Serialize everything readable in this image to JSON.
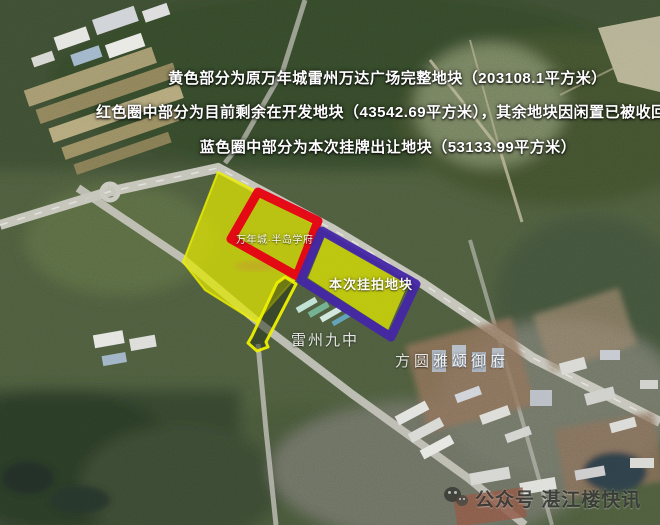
{
  "header": {
    "line1": "黄色部分为原万年城雷州万达广场完整地块（203108.1平方米）",
    "line2": "红色圈中部分为目前剩余在开发地块（43542.69平方米），其余地块因闲置已被收回",
    "line3": "蓝色圈中部分为本次挂牌出让地块（53133.99平方米）"
  },
  "map": {
    "labels": {
      "red_plot": "万年城·半岛学府",
      "blue_plot": "本次挂拍地块",
      "school": "雷州九中",
      "estate": "方圆雅颂御府"
    },
    "legend_colors": {
      "yellow": "#e3e900",
      "red": "#e60013",
      "blue": "#4426a6"
    }
  },
  "watermark": {
    "icon": "wechat-icon",
    "text": "公众号 湛江楼快讯"
  }
}
